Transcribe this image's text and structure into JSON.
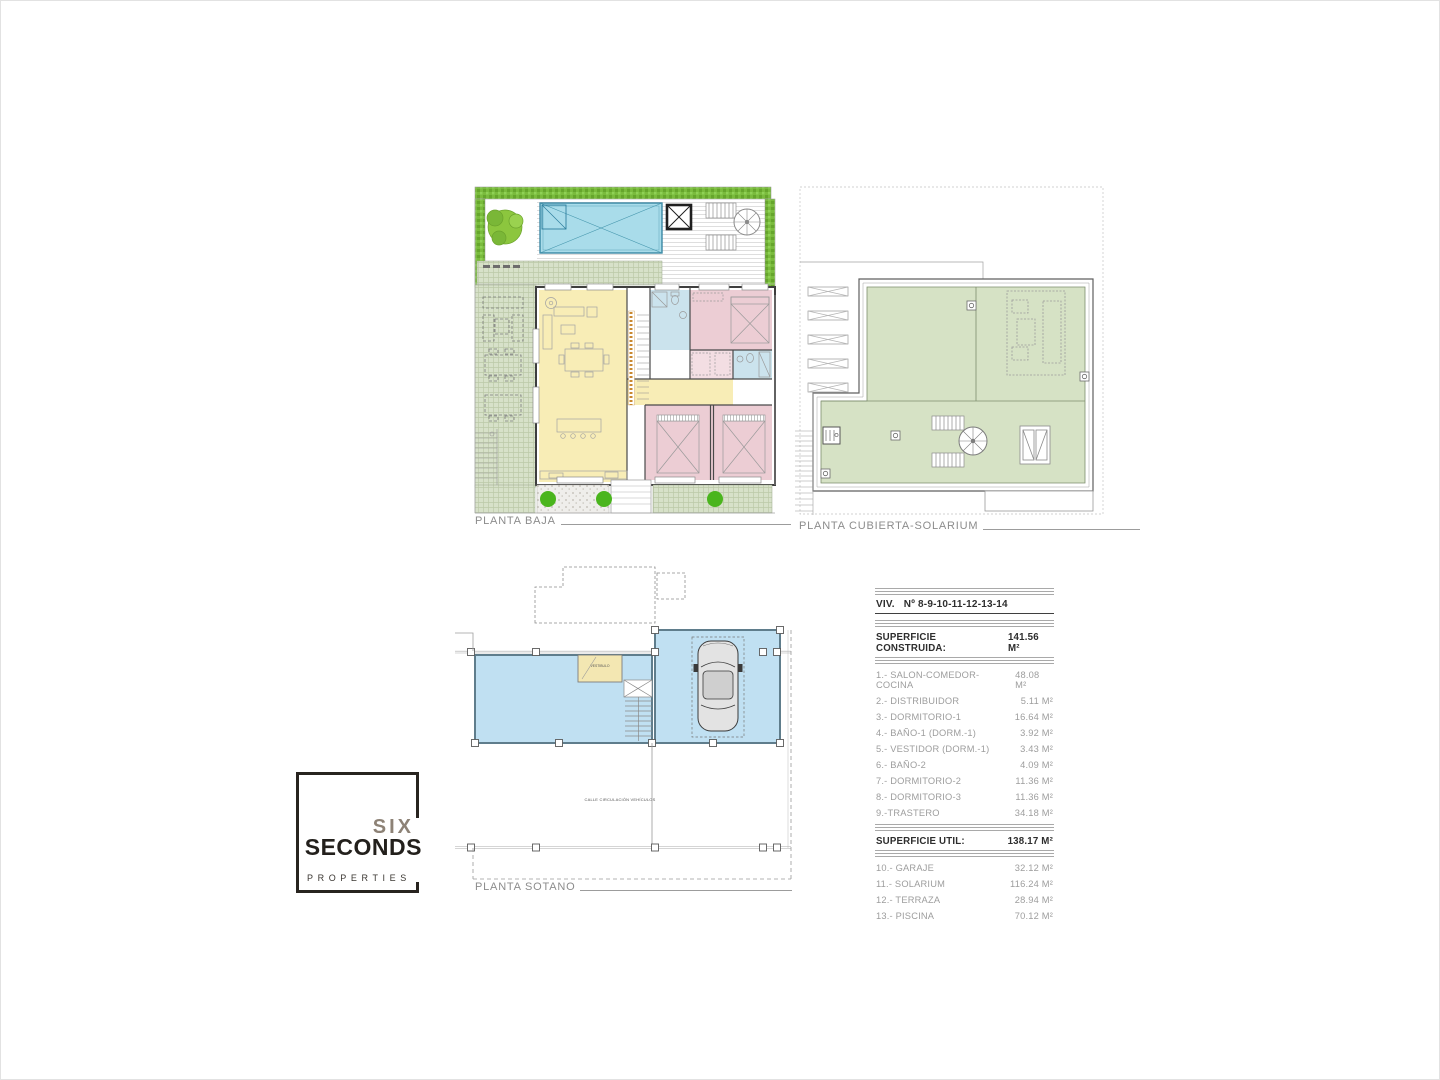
{
  "plans": {
    "planta_baja": {
      "label": "PLANTA BAJA"
    },
    "planta_cubierta_solarium": {
      "label": "PLANTA CUBIERTA-SOLARIUM"
    },
    "planta_sotano": {
      "label": "PLANTA SOTANO",
      "street_label": "CALLE CIRCULACIÓN VEHÍCULOS",
      "vestibule_label": "VESTIBULO"
    }
  },
  "area_table": {
    "title_prefix": "VIV.",
    "title_number": "Nº 8-9-10-11-12-13-14",
    "superficie_construida": {
      "label": "SUPERFICIE CONSTRUIDA:",
      "area": "141.56 M²"
    },
    "construida_rows": [
      {
        "label": "1.- SALON-COMEDOR-COCINA",
        "area": "48.08 M²"
      },
      {
        "label": "2.- DISTRIBUIDOR",
        "area": "5.11 M²"
      },
      {
        "label": "3.- DORMITORIO-1",
        "area": "16.64 M²"
      },
      {
        "label": "4.- BAÑO-1 (DORM.-1)",
        "area": "3.92 M²"
      },
      {
        "label": "5.- VESTIDOR (DORM.-1)",
        "area": "3.43 M²"
      },
      {
        "label": "6.- BAÑO-2",
        "area": "4.09 M²"
      },
      {
        "label": "7.- DORMITORIO-2",
        "area": "11.36 M²"
      },
      {
        "label": "8.- DORMITORIO-3",
        "area": "11.36 M²"
      },
      {
        "label": "9.-TRASTERO",
        "area": "34.18 M²"
      }
    ],
    "superficie_util": {
      "label": "SUPERFICIE UTIL:",
      "area": "138.17 M²"
    },
    "util_rows": [
      {
        "label": "10.- GARAJE",
        "area": "32.12 M²"
      },
      {
        "label": "11.- SOLARIUM",
        "area": "116.24 M²"
      },
      {
        "label": "12.- TERRAZA",
        "area": "28.94 M²"
      },
      {
        "label": "13.- PISCINA",
        "area": "70.12 M²"
      }
    ]
  },
  "logo": {
    "line1": "SIX",
    "line2": "SECONDS",
    "line3": "PROPERTIES"
  },
  "palette": {
    "pool_blue": "#a9dcea",
    "room_yellow": "#f8edb6",
    "bedroom_pink": "#eccdd4",
    "bath_blue": "#cbe3ed",
    "solarium_green": "#d6e2c5",
    "hedge_green": "#7abb3d",
    "basement_blue": "#c0e0f2",
    "shrub_green": "#4ab51d"
  }
}
